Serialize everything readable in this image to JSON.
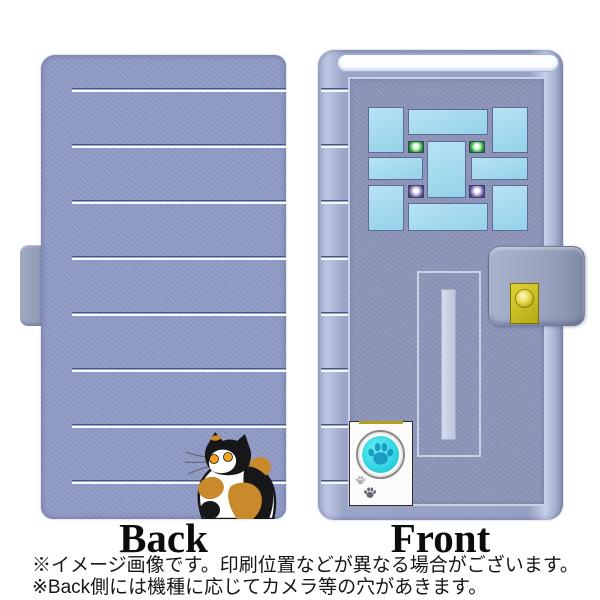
{
  "product": {
    "type": "flip phone case product image",
    "back_panel": {
      "label": "Back",
      "stripe_count": 8,
      "decor": "calico cat illustration over horizontal pinstripes"
    },
    "front_panel": {
      "label": "Front",
      "decor": "apartment door design: transom window, pane grid with green and purple lights, mail slot, gold doorbell on magnetic strap, pet door with cyan paw button"
    }
  },
  "notes": {
    "line1": "※イメージ画像です。印刷位置などが異なる場合がございます。",
    "line2": "※Back側には機種に応じてカメラ等の穴があきます。"
  },
  "colors": {
    "case_base": "#8f9ac4",
    "case_edge_light": "#c6cfe8",
    "door_panel": "#8b94b7",
    "stripe_white": "#f8fafc",
    "stripe_shadow": "#46568c",
    "window_pane": "#a5dbee",
    "light_green": "#1e7c31",
    "light_purple": "#4a3f85",
    "doorbell_gold": "#c8b71e",
    "pet_door_white": "#fbfbfc",
    "paw_button_cyan": "#2bd0e0",
    "paw_print_teal": "#1c9cc4",
    "cat_orange": "#c98a2b",
    "cat_black": "#17171a",
    "cat_eye": "#f2a11b"
  }
}
